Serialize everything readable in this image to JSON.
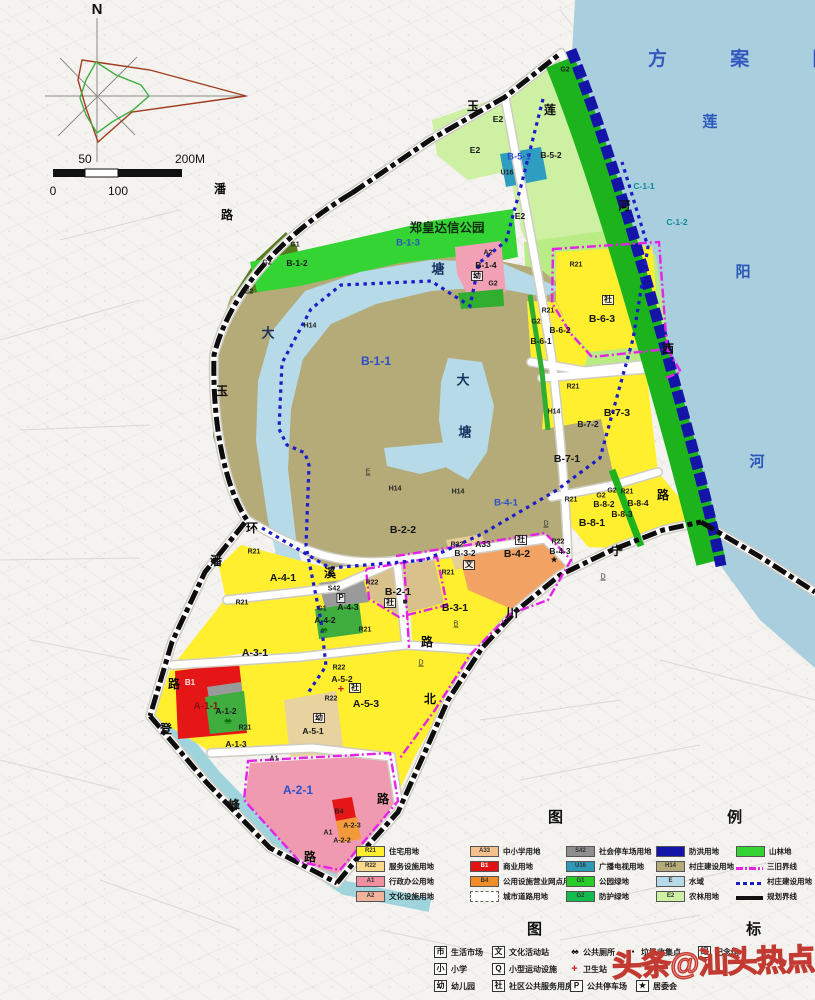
{
  "header": {
    "title": "方 案 图"
  },
  "compass": {
    "n": "N"
  },
  "scale": {
    "fifty": "50",
    "two_hundred": "200M",
    "zero": "0",
    "hundred": "100"
  },
  "footer": {
    "watermark": "头条@汕头热点"
  },
  "colors": {
    "water": "#a9cede",
    "flood_band": "#1414a8",
    "greenbelt": "#1db31d",
    "park_green": "#35d435",
    "village_olive": "#b4ab79",
    "residential_yellow": "#ffef2e",
    "magenta_boundary": "#e622e6",
    "plan_boundary": "#111111",
    "title_blue": "#3558be",
    "watermark_red": "#c23a31"
  },
  "map_labels": [
    {
      "t": "莲",
      "x": 710,
      "y": 122,
      "k": "rv",
      "n": "river-name-char"
    },
    {
      "t": "阳",
      "x": 743,
      "y": 272,
      "k": "rv",
      "n": "river-name-char"
    },
    {
      "t": "河",
      "x": 757,
      "y": 462,
      "k": "rv",
      "n": "river-name-char"
    },
    {
      "t": "玉",
      "x": 473,
      "y": 106,
      "k": "rd",
      "n": "road-label"
    },
    {
      "t": "莲",
      "x": 550,
      "y": 110,
      "k": "rd",
      "n": "road-label"
    },
    {
      "t": "潘",
      "x": 220,
      "y": 189,
      "k": "rd",
      "n": "road-label"
    },
    {
      "t": "路",
      "x": 227,
      "y": 215,
      "k": "rd",
      "n": "road-label"
    },
    {
      "t": "玉",
      "x": 222,
      "y": 391,
      "k": "rd",
      "n": "road-label"
    },
    {
      "t": "环",
      "x": 252,
      "y": 528,
      "k": "rd",
      "n": "road-label"
    },
    {
      "t": "潘",
      "x": 216,
      "y": 561,
      "k": "rd",
      "n": "road-label"
    },
    {
      "t": "溪",
      "x": 330,
      "y": 573,
      "k": "rd",
      "n": "road-label"
    },
    {
      "t": "路",
      "x": 427,
      "y": 642,
      "k": "rd",
      "n": "road-label"
    },
    {
      "t": "河",
      "x": 624,
      "y": 206,
      "k": "rd",
      "n": "road-label"
    },
    {
      "t": "西",
      "x": 668,
      "y": 349,
      "k": "rd",
      "n": "road-label"
    },
    {
      "t": "路",
      "x": 663,
      "y": 495,
      "k": "rd",
      "n": "road-label"
    },
    {
      "t": "宁",
      "x": 617,
      "y": 551,
      "k": "rd",
      "n": "road-label"
    },
    {
      "t": "川",
      "x": 512,
      "y": 613,
      "k": "rd",
      "n": "road-label"
    },
    {
      "t": "北",
      "x": 430,
      "y": 699,
      "k": "rd",
      "n": "road-label"
    },
    {
      "t": "路",
      "x": 383,
      "y": 799,
      "k": "rd",
      "n": "road-label"
    },
    {
      "t": "路",
      "x": 174,
      "y": 684,
      "k": "rd",
      "n": "road-label"
    },
    {
      "t": "登",
      "x": 166,
      "y": 729,
      "k": "rd",
      "n": "road-label"
    },
    {
      "t": "峰",
      "x": 234,
      "y": 805,
      "k": "rd",
      "n": "road-label"
    },
    {
      "t": "路",
      "x": 310,
      "y": 857,
      "k": "rd",
      "n": "road-label"
    },
    {
      "t": "大",
      "x": 268,
      "y": 333,
      "k": "pd",
      "n": "pond-name-char"
    },
    {
      "t": "塘",
      "x": 438,
      "y": 269,
      "k": "pd",
      "n": "pond-name-char"
    },
    {
      "t": "大",
      "x": 463,
      "y": 380,
      "k": "pd",
      "n": "pond-name-char"
    },
    {
      "t": "塘",
      "x": 465,
      "y": 432,
      "k": "pd",
      "n": "pond-name-char"
    },
    {
      "t": "郑皇达信公园",
      "x": 447,
      "y": 228,
      "k": "pk",
      "n": "park-name"
    },
    {
      "t": "B-1-3",
      "x": 408,
      "y": 243,
      "k": "bl",
      "n": "parcel-label"
    },
    {
      "t": "G1",
      "x": 295,
      "y": 245,
      "k": "sm",
      "n": "parcel-label"
    },
    {
      "t": "G2",
      "x": 267,
      "y": 263,
      "k": "sm",
      "n": "parcel-label"
    },
    {
      "t": "B-1-2",
      "x": 297,
      "y": 263,
      "k": "pc",
      "n": "parcel-label"
    },
    {
      "t": "E2",
      "x": 249,
      "y": 292,
      "k": "sm",
      "n": "parcel-label"
    },
    {
      "t": "E2",
      "x": 498,
      "y": 119,
      "k": "pc",
      "n": "parcel-label"
    },
    {
      "t": "E2",
      "x": 475,
      "y": 150,
      "k": "pc",
      "n": "parcel-label"
    },
    {
      "t": "E2",
      "x": 520,
      "y": 216,
      "k": "pc",
      "n": "parcel-label"
    },
    {
      "t": "B-5-1",
      "x": 519,
      "y": 157,
      "k": "bl",
      "n": "parcel-label"
    },
    {
      "t": "B-5-2",
      "x": 551,
      "y": 155,
      "k": "pc",
      "n": "parcel-label"
    },
    {
      "t": "U16",
      "x": 507,
      "y": 173,
      "k": "sm",
      "n": "parcel-label"
    },
    {
      "t": "G2",
      "x": 565,
      "y": 70,
      "k": "sm",
      "n": "parcel-label"
    },
    {
      "t": "C-1-1",
      "x": 644,
      "y": 186,
      "k": "tl",
      "n": "parcel-label"
    },
    {
      "t": "C-1-2",
      "x": 677,
      "y": 222,
      "k": "tl",
      "n": "parcel-label"
    },
    {
      "t": "A2",
      "x": 488,
      "y": 253,
      "k": "sm",
      "n": "parcel-label"
    },
    {
      "t": "B-1-4",
      "x": 486,
      "y": 265,
      "k": "pc",
      "n": "parcel-label"
    },
    {
      "t": "幼",
      "x": 477,
      "y": 276,
      "k": "bx",
      "n": "kindergarten-icon"
    },
    {
      "t": "G2",
      "x": 493,
      "y": 284,
      "k": "sm",
      "n": "parcel-label"
    },
    {
      "t": "R21",
      "x": 576,
      "y": 265,
      "k": "sm",
      "n": "parcel-label"
    },
    {
      "t": "社",
      "x": 608,
      "y": 300,
      "k": "bx",
      "n": "community-icon"
    },
    {
      "t": "B-6-3",
      "x": 602,
      "y": 319,
      "k": "lg",
      "n": "parcel-label"
    },
    {
      "t": "G2",
      "x": 536,
      "y": 322,
      "k": "sm",
      "n": "parcel-label"
    },
    {
      "t": "R21",
      "x": 548,
      "y": 311,
      "k": "sm",
      "n": "parcel-label"
    },
    {
      "t": "B-6-2",
      "x": 560,
      "y": 330,
      "k": "pc",
      "n": "parcel-label"
    },
    {
      "t": "B-6-1",
      "x": 541,
      "y": 341,
      "k": "pc",
      "n": "parcel-label"
    },
    {
      "t": "R21",
      "x": 573,
      "y": 387,
      "k": "sm",
      "n": "parcel-label"
    },
    {
      "t": "B-7-3",
      "x": 617,
      "y": 413,
      "k": "lg",
      "n": "parcel-label"
    },
    {
      "t": "B-7-2",
      "x": 588,
      "y": 424,
      "k": "pc",
      "n": "parcel-label"
    },
    {
      "t": "H14",
      "x": 554,
      "y": 412,
      "k": "sm",
      "n": "parcel-label"
    },
    {
      "t": "B-7-1",
      "x": 567,
      "y": 459,
      "k": "lg",
      "n": "parcel-label"
    },
    {
      "t": "R21",
      "x": 571,
      "y": 500,
      "k": "sm",
      "n": "parcel-label"
    },
    {
      "t": "G2",
      "x": 601,
      "y": 496,
      "k": "sm",
      "n": "parcel-label"
    },
    {
      "t": "G2",
      "x": 612,
      "y": 491,
      "k": "sm",
      "n": "parcel-label"
    },
    {
      "t": "R21",
      "x": 627,
      "y": 492,
      "k": "sm",
      "n": "parcel-label"
    },
    {
      "t": "B-8-2",
      "x": 604,
      "y": 504,
      "k": "pc",
      "n": "parcel-label"
    },
    {
      "t": "B-8-4",
      "x": 638,
      "y": 503,
      "k": "pc",
      "n": "parcel-label"
    },
    {
      "t": "B-8-3",
      "x": 622,
      "y": 514,
      "k": "pc",
      "n": "parcel-label"
    },
    {
      "t": "B-8-1",
      "x": 592,
      "y": 523,
      "k": "lg",
      "n": "parcel-label"
    },
    {
      "t": "H14",
      "x": 310,
      "y": 326,
      "k": "sm",
      "n": "parcel-label"
    },
    {
      "t": "B-1-1",
      "x": 376,
      "y": 361,
      "k": "blg",
      "n": "parcel-label"
    },
    {
      "t": "H14",
      "x": 395,
      "y": 489,
      "k": "sm",
      "n": "parcel-label"
    },
    {
      "t": "H14",
      "x": 458,
      "y": 492,
      "k": "sm",
      "n": "parcel-label"
    },
    {
      "t": "B-2-2",
      "x": 403,
      "y": 530,
      "k": "lg",
      "n": "parcel-label"
    },
    {
      "t": "B-4-1",
      "x": 506,
      "y": 503,
      "k": "bl",
      "n": "parcel-label"
    },
    {
      "t": "E",
      "x": 368,
      "y": 472,
      "k": "ul",
      "n": "grade-marker"
    },
    {
      "t": "D",
      "x": 546,
      "y": 524,
      "k": "ul",
      "n": "grade-marker"
    },
    {
      "t": "D",
      "x": 603,
      "y": 577,
      "k": "ul",
      "n": "grade-marker"
    },
    {
      "t": "B",
      "x": 456,
      "y": 624,
      "k": "ul",
      "n": "grade-marker"
    },
    {
      "t": "D",
      "x": 421,
      "y": 663,
      "k": "ul",
      "n": "grade-marker"
    },
    {
      "t": "A33",
      "x": 483,
      "y": 544,
      "k": "pc",
      "n": "parcel-label"
    },
    {
      "t": "社",
      "x": 521,
      "y": 540,
      "k": "bx",
      "n": "community-icon"
    },
    {
      "t": "R22",
      "x": 558,
      "y": 542,
      "k": "sm",
      "n": "parcel-label"
    },
    {
      "t": "B-4-3",
      "x": 560,
      "y": 551,
      "k": "pc",
      "n": "parcel-label"
    },
    {
      "t": "★",
      "x": 554,
      "y": 560,
      "k": "st",
      "n": "committee-icon"
    },
    {
      "t": "B-4-2",
      "x": 517,
      "y": 554,
      "k": "lg",
      "n": "parcel-label"
    },
    {
      "t": "R22",
      "x": 457,
      "y": 545,
      "k": "sm",
      "n": "parcel-label"
    },
    {
      "t": "B-3-2",
      "x": 465,
      "y": 553,
      "k": "pc",
      "n": "parcel-label"
    },
    {
      "t": "文",
      "x": 469,
      "y": 565,
      "k": "bx",
      "n": "culture-icon"
    },
    {
      "t": "R21",
      "x": 448,
      "y": 573,
      "k": "sm",
      "n": "parcel-label"
    },
    {
      "t": "B-3-1",
      "x": 455,
      "y": 608,
      "k": "lg",
      "n": "parcel-label"
    },
    {
      "t": "R22",
      "x": 372,
      "y": 583,
      "k": "sm",
      "n": "parcel-label"
    },
    {
      "t": "B-2-1",
      "x": 398,
      "y": 592,
      "k": "lg",
      "n": "parcel-label"
    },
    {
      "t": "社",
      "x": 390,
      "y": 603,
      "k": "bx",
      "n": "community-icon"
    },
    {
      "t": "■",
      "x": 405,
      "y": 602,
      "k": "sq",
      "n": "block-icon"
    },
    {
      "t": "R21",
      "x": 254,
      "y": 552,
      "k": "sm",
      "n": "parcel-label"
    },
    {
      "t": "A-4-1",
      "x": 283,
      "y": 578,
      "k": "lg",
      "n": "parcel-label"
    },
    {
      "t": "S42",
      "x": 334,
      "y": 589,
      "k": "sm",
      "n": "parcel-label"
    },
    {
      "t": "P",
      "x": 341,
      "y": 598,
      "k": "bx",
      "n": "parking-icon"
    },
    {
      "t": "A-4-3",
      "x": 348,
      "y": 607,
      "k": "pc",
      "n": "parcel-label"
    },
    {
      "t": "G1",
      "x": 322,
      "y": 609,
      "k": "sm",
      "n": "parcel-label"
    },
    {
      "t": "A-4-2",
      "x": 325,
      "y": 620,
      "k": "pc",
      "n": "parcel-label"
    },
    {
      "t": "♠♠",
      "x": 323,
      "y": 630,
      "k": "tr",
      "n": "trees-icon"
    },
    {
      "t": "R21",
      "x": 242,
      "y": 603,
      "k": "sm",
      "n": "parcel-label"
    },
    {
      "t": "A-3-1",
      "x": 255,
      "y": 653,
      "k": "lg",
      "n": "parcel-label"
    },
    {
      "t": "R21",
      "x": 365,
      "y": 630,
      "k": "sm",
      "n": "parcel-label"
    },
    {
      "t": "A-5-3",
      "x": 366,
      "y": 704,
      "k": "lg",
      "n": "parcel-label"
    },
    {
      "t": "R22",
      "x": 339,
      "y": 668,
      "k": "sm",
      "n": "parcel-label"
    },
    {
      "t": "A-5-2",
      "x": 342,
      "y": 679,
      "k": "pc",
      "n": "parcel-label"
    },
    {
      "t": "+",
      "x": 341,
      "y": 690,
      "k": "plus",
      "n": "health-icon"
    },
    {
      "t": "社",
      "x": 355,
      "y": 688,
      "k": "bx",
      "n": "community-icon"
    },
    {
      "t": "R22",
      "x": 331,
      "y": 699,
      "k": "sm",
      "n": "parcel-label"
    },
    {
      "t": "幼",
      "x": 319,
      "y": 718,
      "k": "bx",
      "n": "kindergarten-icon"
    },
    {
      "t": "A-5-1",
      "x": 313,
      "y": 731,
      "k": "pc",
      "n": "parcel-label"
    },
    {
      "t": "B1",
      "x": 190,
      "y": 683,
      "k": "wt",
      "n": "parcel-label"
    },
    {
      "t": "A-1-1",
      "x": 206,
      "y": 707,
      "k": "dk",
      "n": "parcel-label"
    },
    {
      "t": "A-1-2",
      "x": 226,
      "y": 711,
      "k": "pc",
      "n": "parcel-label"
    },
    {
      "t": "♠♠",
      "x": 227,
      "y": 721,
      "k": "tr",
      "n": "trees-icon"
    },
    {
      "t": "R21",
      "x": 245,
      "y": 728,
      "k": "sm",
      "n": "parcel-label"
    },
    {
      "t": "A-1-3",
      "x": 236,
      "y": 744,
      "k": "pc",
      "n": "parcel-label"
    },
    {
      "t": "A1",
      "x": 274,
      "y": 759,
      "k": "sm",
      "n": "parcel-label"
    },
    {
      "t": "A-2-1",
      "x": 298,
      "y": 790,
      "k": "blg",
      "n": "parcel-label"
    },
    {
      "t": "B4",
      "x": 339,
      "y": 812,
      "k": "sm",
      "n": "parcel-label"
    },
    {
      "t": "A-2-3",
      "x": 352,
      "y": 826,
      "k": "sm",
      "n": "parcel-label"
    },
    {
      "t": "A1",
      "x": 328,
      "y": 833,
      "k": "sm",
      "n": "parcel-label"
    },
    {
      "t": "A-2-2",
      "x": 342,
      "y": 841,
      "k": "sm",
      "n": "parcel-label"
    }
  ],
  "legend": {
    "title": "图 例",
    "y0": 846,
    "dy": 15,
    "columns": [
      {
        "x": 356,
        "items": [
          {
            "code": "R21",
            "color": "#ffef2e",
            "label": "住宅用地"
          },
          {
            "code": "R22",
            "color": "#fbd98b",
            "label": "服务设施用地"
          },
          {
            "code": "A1",
            "color": "#ef8f9f",
            "label": "行政办公用地"
          },
          {
            "code": "A2",
            "color": "#f2b39b",
            "label": "文化设施用地"
          }
        ]
      },
      {
        "x": 470,
        "items": [
          {
            "code": "A33",
            "color": "#f4c08b",
            "label": "中小学用地"
          },
          {
            "code": "B1",
            "color": "#e31212",
            "label": "商业用地"
          },
          {
            "code": "B4",
            "color": "#f08c28",
            "label": "公用设施营业网点用地"
          },
          {
            "sw": "road",
            "label": "城市道路用地"
          }
        ]
      },
      {
        "x": 566,
        "items": [
          {
            "code": "S42",
            "color": "#8f8f8f",
            "label": "社会停车场用地"
          },
          {
            "code": "U16",
            "color": "#2e9ab8",
            "label": "广播电视用地"
          },
          {
            "code": "G1",
            "color": "#27cd27",
            "label": "公园绿地"
          },
          {
            "code": "G2",
            "color": "#12bd4d",
            "label": "防护绿地"
          }
        ]
      },
      {
        "x": 656,
        "items": [
          {
            "code": "",
            "color": "#1414a8",
            "label": "防洪用地"
          },
          {
            "code": "H14",
            "color": "#b4ab79",
            "label": "村庄建设用地"
          },
          {
            "code": "E",
            "color": "#b6dae8",
            "label": "水域"
          },
          {
            "code": "E2",
            "color": "#cdf0a2",
            "label": "农林用地"
          }
        ]
      },
      {
        "x": 736,
        "items": [
          {
            "code": "",
            "color": "#35d435",
            "label": "山林地"
          },
          {
            "sw": "mline",
            "label": "三旧界线"
          },
          {
            "sw": "bdots",
            "label": "村庄建设用地"
          },
          {
            "sw": "kline",
            "label": "规划界线"
          }
        ]
      }
    ]
  },
  "icon_legend": {
    "title": "图 标",
    "y0": 946,
    "dy": 17,
    "items": [
      {
        "x": 434,
        "r": 0,
        "g": "市",
        "t": "生活市场",
        "s": "box"
      },
      {
        "x": 492,
        "r": 0,
        "g": "文",
        "t": "文化活动站",
        "s": "box"
      },
      {
        "x": 570,
        "r": 0,
        "g": "♠♠",
        "t": "公共厕所",
        "s": "plain"
      },
      {
        "x": 628,
        "r": 0,
        "g": "▪",
        "t": "垃圾收集点",
        "s": "plain"
      },
      {
        "x": 698,
        "r": 0,
        "g": "纪",
        "t": "纪念馆",
        "s": "box"
      },
      {
        "x": 434,
        "r": 1,
        "g": "小",
        "t": "小学",
        "s": "box"
      },
      {
        "x": 492,
        "r": 1,
        "g": "Q",
        "t": "小型运动设施",
        "s": "box"
      },
      {
        "x": 570,
        "r": 1,
        "g": "+",
        "t": "卫生站",
        "s": "red"
      },
      {
        "x": 434,
        "r": 2,
        "g": "幼",
        "t": "幼儿园",
        "s": "box"
      },
      {
        "x": 492,
        "r": 2,
        "g": "社",
        "t": "社区公共服务用房",
        "s": "box"
      },
      {
        "x": 570,
        "r": 2,
        "g": "P",
        "t": "公共停车场",
        "s": "box"
      },
      {
        "x": 636,
        "r": 2,
        "g": "★",
        "t": "居委会",
        "s": "box"
      }
    ]
  }
}
